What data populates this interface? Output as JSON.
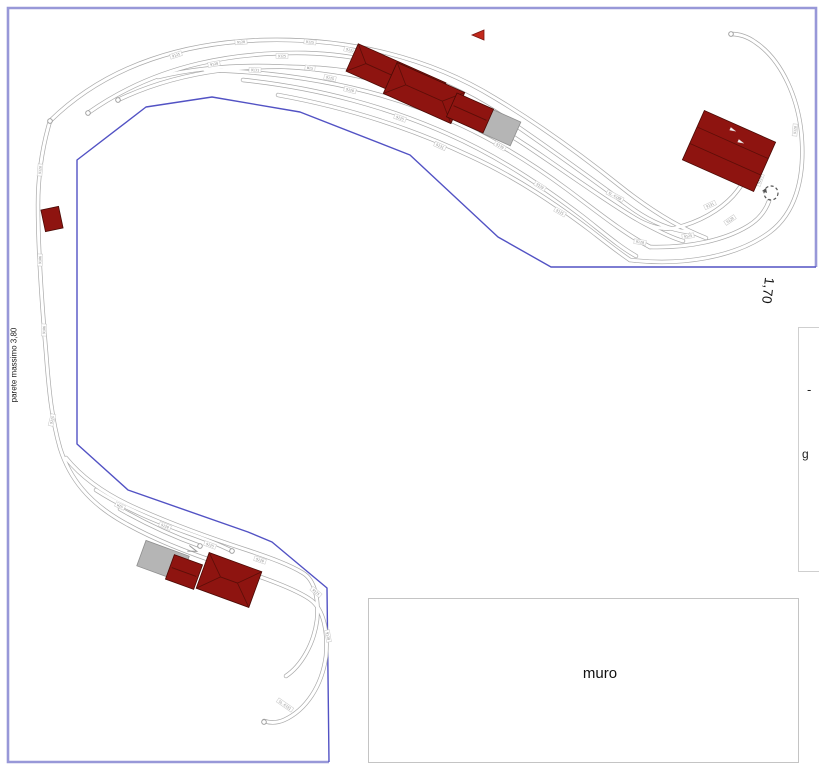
{
  "canvas": {
    "width": 819,
    "height": 768,
    "background": "#ffffff"
  },
  "labels": {
    "wall_note": "parete massimo 3,80",
    "dimension_right": "1,70",
    "wall": "muro",
    "edge_fragment_dash": "-",
    "edge_fragment_g": "g"
  },
  "colors": {
    "boundary_outer": "#9898d8",
    "boundary_inner": "#5252c4",
    "rail": "#a9a9a9",
    "rail_core": "#ffffff",
    "building_fill": "#8e1410",
    "building_stroke": "#4a0a05",
    "building_ridge": "#5c0e08",
    "building_gray": "#b5b5b5",
    "building_gray_stroke": "#8f8f8f",
    "part_label_text": "#8a8a8a",
    "part_label_border": "#c8c8c8",
    "flag_red": "#c2291c",
    "marker": "#555555"
  },
  "plan": {
    "room": {
      "outer": "M 329 762 L 8 762 L 8 8 L 816 8 L 816 267",
      "inner": "M 816 267 L 551 267 L 498 237 L 410 155 L 300 112 L 212 97 L 146 107 L 77 160 L 77 444 L 128 490 L 248 532 L 272 542 L 327 588 L 329 762"
    },
    "tracks": [
      {
        "id": "arc-1",
        "d": "M 50 121 C 110 62 190 42 265 40 C 350 38 430 58 495 98 C 545 128 585 158 620 186 C 655 214 685 230 706 238"
      },
      {
        "id": "arc-2",
        "d": "M 88 113 C 160 62 240 52 305 53 C 380 55 450 80 508 120 C 556 153 600 185 630 207 C 652 223 672 230 688 232"
      },
      {
        "id": "arc-3",
        "d": "M 118 100 C 185 68 255 64 320 68 C 390 73 455 98 512 136 C 558 167 600 196 628 214 C 648 227 662 230 675 228"
      },
      {
        "id": "arc-4",
        "d": "M 158 77 C 230 60 310 64 375 80 C 440 96 500 126 548 160 C 588 188 620 210 645 224 C 660 232 672 238 683 241"
      },
      {
        "id": "arc-5",
        "d": "M 205 70 C 290 72 360 86 420 108 C 475 128 525 158 568 190 C 600 214 625 234 650 247"
      },
      {
        "id": "arc-6",
        "d": "M 243 80 C 320 88 390 108 448 134 C 500 157 545 188 582 216 C 605 234 620 247 636 256"
      },
      {
        "id": "arc-7",
        "d": "M 278 95 C 350 108 415 130 470 156 C 518 178 558 206 590 230 C 608 244 618 252 630 260"
      },
      {
        "id": "return-outer",
        "d": "M 630 260 C 680 266 735 258 770 232 C 795 213 804 180 802 142 C 800 100 782 60 755 42 C 748 37 740 34 731 34"
      },
      {
        "id": "return-mid",
        "d": "M 650 247 C 690 248 725 240 748 226 C 758 220 765 212 769 201"
      },
      {
        "id": "return-inner",
        "d": "M 675 228 C 700 222 720 210 733 196 C 740 188 745 180 748 174"
      },
      {
        "id": "left-main",
        "d": "M 50 121 C 42 148 38 175 38 205 C 38 250 42 305 46 352 C 49 392 52 420 60 448 C 70 480 90 502 118 519 C 148 537 185 552 225 565 C 262 577 296 589 311 600 C 324 610 328 632 326 656 C 322 686 306 710 284 720 C 277 723 270 723 264 721"
      },
      {
        "id": "yard-loop",
        "d": "M 66 458 C 84 480 108 496 138 509 C 172 524 210 538 247 550 C 271 558 290 565 303 573 C 315 580 319 600 317 620 C 314 644 301 666 286 676"
      },
      {
        "id": "yard-siding-1",
        "d": "M 96 490 C 124 508 155 521 188 533 C 205 539 220 545 232 551"
      },
      {
        "id": "yard-siding-2",
        "d": "M 120 509 C 148 525 175 537 200 546"
      }
    ],
    "buildings": [
      {
        "id": "depot-top-left-a",
        "cx": 396,
        "cy": 77,
        "w": 96,
        "h": 30,
        "rot": 24,
        "kind": "red",
        "style": "hip"
      },
      {
        "id": "depot-top-left-b",
        "cx": 424,
        "cy": 93,
        "w": 74,
        "h": 34,
        "rot": 24,
        "kind": "red",
        "style": "hip"
      },
      {
        "id": "shed-top-gray",
        "cx": 500,
        "cy": 127,
        "w": 34,
        "h": 26,
        "rot": 24,
        "kind": "gray",
        "style": "plain"
      },
      {
        "id": "shed-top-red",
        "cx": 470,
        "cy": 113,
        "w": 40,
        "h": 26,
        "rot": 24,
        "kind": "red",
        "style": "ridge"
      },
      {
        "id": "depot-right",
        "cx": 729,
        "cy": 151,
        "w": 78,
        "h": 54,
        "rot": 24,
        "kind": "red",
        "style": "strips"
      },
      {
        "id": "hut-left",
        "cx": 52,
        "cy": 219,
        "w": 18,
        "h": 22,
        "rot": -12,
        "kind": "red",
        "style": "plain"
      },
      {
        "id": "shed-yard-gray",
        "cx": 163,
        "cy": 561,
        "w": 46,
        "h": 27,
        "rot": 20,
        "kind": "gray",
        "style": "plain"
      },
      {
        "id": "shed-yard-red",
        "cx": 184,
        "cy": 572,
        "w": 30,
        "h": 26,
        "rot": 20,
        "kind": "red",
        "style": "ridge"
      },
      {
        "id": "depot-yard",
        "cx": 229,
        "cy": 580,
        "w": 56,
        "h": 38,
        "rot": 20,
        "kind": "red",
        "style": "hip"
      }
    ],
    "part_labels": [
      {
        "x": 176,
        "y": 55,
        "a": -18,
        "t": "9125"
      },
      {
        "x": 241,
        "y": 42,
        "a": -4,
        "t": "9120"
      },
      {
        "x": 310,
        "y": 42,
        "a": 6,
        "t": "9125"
      },
      {
        "x": 350,
        "y": 50,
        "a": 14,
        "t": "9131"
      },
      {
        "x": 214,
        "y": 64,
        "a": -10,
        "t": "9120"
      },
      {
        "x": 282,
        "y": 56,
        "a": 1,
        "t": "9125"
      },
      {
        "x": 355,
        "y": 66,
        "a": 14,
        "t": "9120"
      },
      {
        "x": 430,
        "y": 86,
        "a": 25,
        "t": "9170"
      },
      {
        "x": 255,
        "y": 70,
        "a": 2,
        "t": "9131"
      },
      {
        "x": 330,
        "y": 78,
        "a": 12,
        "t": "9125"
      },
      {
        "x": 418,
        "y": 106,
        "a": 26,
        "t": "9120"
      },
      {
        "x": 310,
        "y": 68,
        "a": 8,
        "t": "W15"
      },
      {
        "x": 470,
        "y": 122,
        "a": 28,
        "t": "9125"
      },
      {
        "x": 350,
        "y": 90,
        "a": 14,
        "t": "9120"
      },
      {
        "x": 500,
        "y": 146,
        "a": 30,
        "t": "9170"
      },
      {
        "x": 400,
        "y": 118,
        "a": 20,
        "t": "9125"
      },
      {
        "x": 540,
        "y": 186,
        "a": 32,
        "t": "9120"
      },
      {
        "x": 440,
        "y": 146,
        "a": 24,
        "t": "9131"
      },
      {
        "x": 560,
        "y": 212,
        "a": 30,
        "t": "9125"
      },
      {
        "x": 615,
        "y": 196,
        "a": 28,
        "t": "SL-E188"
      },
      {
        "x": 640,
        "y": 242,
        "a": 8,
        "t": "9120"
      },
      {
        "x": 688,
        "y": 236,
        "a": -8,
        "t": "9125"
      },
      {
        "x": 730,
        "y": 220,
        "a": -35,
        "t": "9120"
      },
      {
        "x": 760,
        "y": 180,
        "a": -70,
        "t": "9125"
      },
      {
        "x": 795,
        "y": 130,
        "a": -85,
        "t": "9120"
      },
      {
        "x": 710,
        "y": 205,
        "a": -25,
        "t": "9131"
      },
      {
        "x": 40,
        "y": 170,
        "a": -85,
        "t": "9120"
      },
      {
        "x": 40,
        "y": 260,
        "a": -88,
        "t": "9106"
      },
      {
        "x": 44,
        "y": 330,
        "a": -88,
        "t": "9106"
      },
      {
        "x": 52,
        "y": 420,
        "a": -75,
        "t": "9125"
      },
      {
        "x": 120,
        "y": 506,
        "a": 26,
        "t": "W15"
      },
      {
        "x": 165,
        "y": 526,
        "a": 22,
        "t": "9120"
      },
      {
        "x": 210,
        "y": 545,
        "a": 20,
        "t": "9125"
      },
      {
        "x": 260,
        "y": 560,
        "a": 18,
        "t": "9120"
      },
      {
        "x": 316,
        "y": 592,
        "a": 40,
        "t": "9125"
      },
      {
        "x": 328,
        "y": 636,
        "a": 80,
        "t": "9120"
      },
      {
        "x": 285,
        "y": 705,
        "a": 35,
        "t": "SL-E191"
      }
    ],
    "symbols": {
      "rotation_markers": [
        {
          "x": 749,
          "y": 167
        },
        {
          "x": 771,
          "y": 193
        }
      ],
      "end_markers": [
        {
          "x": 50,
          "y": 121
        },
        {
          "x": 88,
          "y": 113
        },
        {
          "x": 118,
          "y": 100
        },
        {
          "x": 731,
          "y": 34
        },
        {
          "x": 264,
          "y": 722
        },
        {
          "x": 232,
          "y": 551
        },
        {
          "x": 200,
          "y": 546
        }
      ],
      "bumper_arrows": [
        {
          "x": 448,
          "y": 118,
          "a": 205
        },
        {
          "x": 193,
          "y": 550,
          "a": 200
        }
      ],
      "flag": {
        "x": 478,
        "y": 35
      },
      "white_marks": [
        {
          "x": 733,
          "y": 130,
          "a": 24
        },
        {
          "x": 741,
          "y": 142,
          "a": 24
        }
      ],
      "edge_dashed_line": {
        "x": 805.5,
        "y1": 470,
        "y2": 506
      },
      "edge_dark_dashes": [
        {
          "x": 816.5,
          "y1": 498,
          "y2": 505
        },
        {
          "x": 816.5,
          "y1": 507,
          "y2": 513
        }
      ]
    }
  }
}
